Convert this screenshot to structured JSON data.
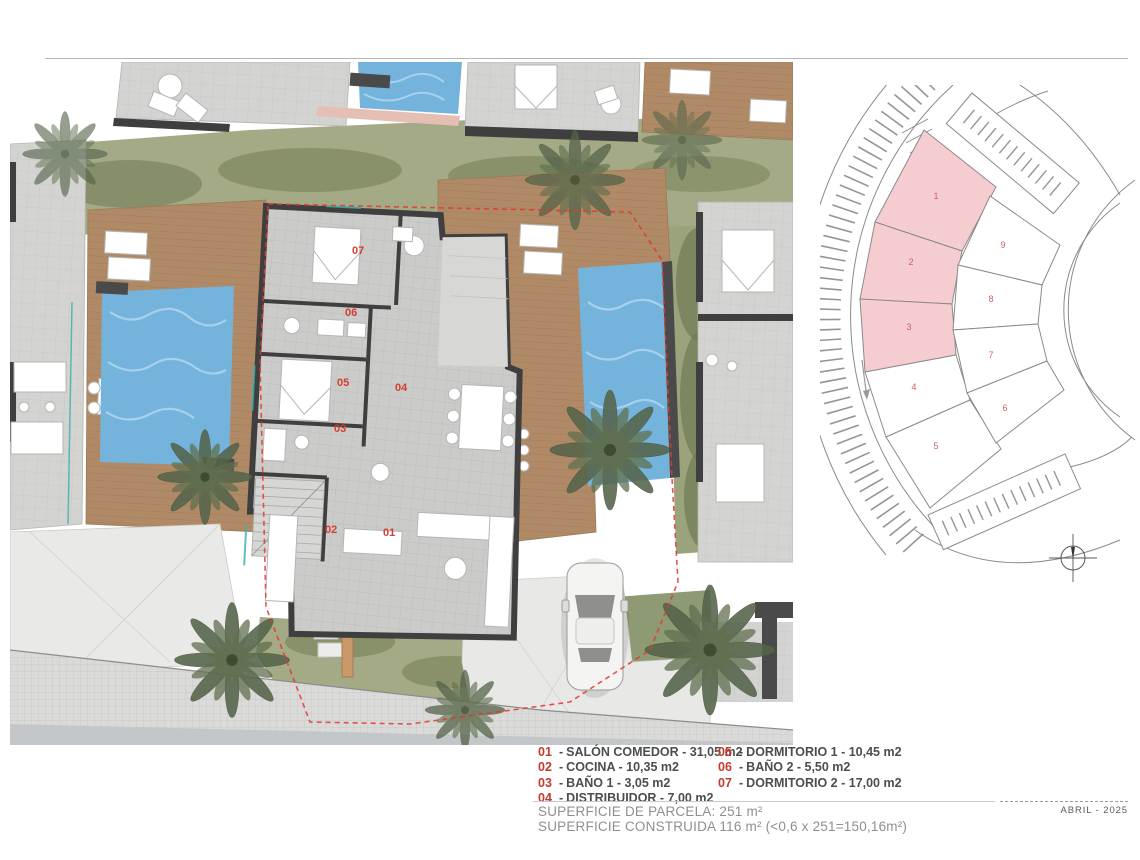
{
  "page": {
    "date": "ABRIL - 2025"
  },
  "legend": {
    "sep": "-",
    "items_left": [
      {
        "num": "01",
        "text": "SALÓN COMEDOR - 31,05 m2"
      },
      {
        "num": "02",
        "text": "COCINA - 10,35 m2"
      },
      {
        "num": "03",
        "text": "BAÑO 1 - 3,05 m2"
      },
      {
        "num": "04",
        "text": "DISTRIBUIDOR - 7,00 m2"
      }
    ],
    "items_right": [
      {
        "num": "05",
        "text": "DORMITORIO 1 - 10,45 m2"
      },
      {
        "num": "06",
        "text": "BAÑO 2 - 5,50 m2"
      },
      {
        "num": "07",
        "text": "DORMITORIO 2 - 17,00 m2"
      }
    ]
  },
  "summary": {
    "line1": "SUPERFICIE DE PARCELA: 251 m²",
    "line2": "SUPERFICIE CONSTRUIDA 116 m² (<0,6 x 251=150,16m²)"
  },
  "floor_plan": {
    "room_labels": [
      {
        "id": "01"
      },
      {
        "id": "02"
      },
      {
        "id": "03"
      },
      {
        "id": "04"
      },
      {
        "id": "05"
      },
      {
        "id": "06"
      },
      {
        "id": "07"
      }
    ]
  },
  "site_plan": {
    "plots": [
      {
        "num": "1",
        "highlighted": true
      },
      {
        "num": "2",
        "highlighted": true
      },
      {
        "num": "3",
        "highlighted": true
      },
      {
        "num": "4",
        "highlighted": false
      },
      {
        "num": "5",
        "highlighted": false
      },
      {
        "num": "6",
        "highlighted": false
      },
      {
        "num": "7",
        "highlighted": false
      },
      {
        "num": "8",
        "highlighted": false
      },
      {
        "num": "9",
        "highlighted": false
      }
    ]
  },
  "colors": {
    "plot_highlight": "#f5cdd0",
    "boundary_red": "#e03a2f",
    "legend_red": "#c23b2e",
    "pool_blue": "#74b4dc",
    "deck_brown": "#b08a66",
    "lawn_green": "#a4aa86",
    "wall_dark": "#3f3f3f"
  }
}
